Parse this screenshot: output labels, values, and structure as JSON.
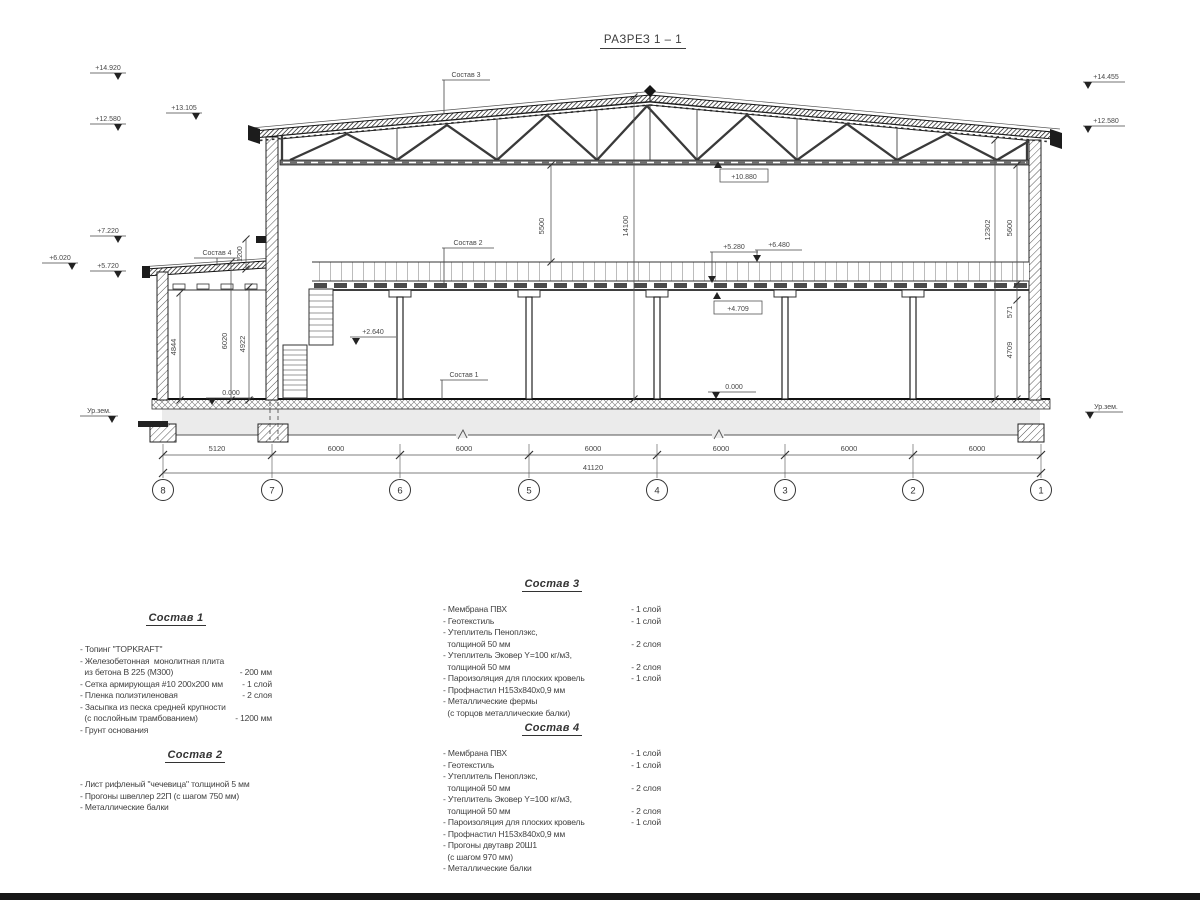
{
  "title": "РАЗРЕЗ 1 – 1",
  "marks": {
    "m14920": "+14.920",
    "m13105": "+13.105",
    "m12580L": "+12.580",
    "m7220": "+7.220",
    "m6020": "+6.020",
    "m5720": "+5.720",
    "m14455": "+14.455",
    "m12580R": "+12.580",
    "m10880": "+10.880",
    "m5280": "+5.280",
    "m6480": "+6.480",
    "m4709": "+4.709",
    "m2640": "+2.640",
    "zeroAnnex": "0.000",
    "zeroHall": "0.000",
    "urzemL": "Ур.зем.",
    "urzemR": "Ур.зем."
  },
  "dims": {
    "v5500": "5500",
    "v14100": "14100",
    "v12302": "12302",
    "v5600": "5600",
    "v571": "571",
    "v4709": "4709",
    "v4844": "4844",
    "v6020": "6020",
    "v4922": "4922",
    "v1200": "1200",
    "bays": [
      "5120",
      "6000",
      "6000",
      "6000",
      "6000",
      "6000",
      "6000"
    ],
    "total": "41120"
  },
  "grid": {
    "bubbles": [
      "8",
      "7",
      "6",
      "5",
      "4",
      "3",
      "2",
      "1"
    ]
  },
  "callouts": {
    "c1": "Состав 1",
    "c2": "Состав 2",
    "c3": "Состав 3",
    "c4": "Состав 4"
  },
  "specs": {
    "s1": {
      "title": "Состав 1",
      "lines": [
        {
          "t": "- Топинг \"TOPKRAFT\"",
          "v": ""
        },
        {
          "t": "- Железобетонная  монолитная плита",
          "v": ""
        },
        {
          "t": "  из бетона В 225 (М300)",
          "v": "- 200 мм"
        },
        {
          "t": "- Сетка армирующая #10 200х200 мм",
          "v": "- 1 слой"
        },
        {
          "t": "- Пленка полиэтиленовая",
          "v": "- 2 слоя"
        },
        {
          "t": "- Засыпка из песка средней крупности",
          "v": ""
        },
        {
          "t": "  (с послойным трамбованием)",
          "v": "- 1200 мм"
        },
        {
          "t": "- Грунт основания",
          "v": ""
        }
      ]
    },
    "s2": {
      "title": "Состав 2",
      "lines": [
        {
          "t": "- Лист рифленый \"чечевица\" толщиной 5 мм",
          "v": ""
        },
        {
          "t": "- Прогоны швеллер 22П (с шагом 750 мм)",
          "v": ""
        },
        {
          "t": "- Металлические балки",
          "v": ""
        }
      ]
    },
    "s3": {
      "title": "Состав 3",
      "lines": [
        {
          "t": "- Мембрана ПВХ",
          "v": "- 1 слой"
        },
        {
          "t": "- Геотекстиль",
          "v": "- 1 слой"
        },
        {
          "t": "- Утеплитель Пеноплэкс,",
          "v": ""
        },
        {
          "t": "  толщиной 50 мм",
          "v": "- 2 слоя"
        },
        {
          "t": "- Утеплитель Эковер Y=100 кг/м3,",
          "v": ""
        },
        {
          "t": "  толщиной 50 мм",
          "v": "- 2 слоя"
        },
        {
          "t": "- Пароизоляция для плоских кровель",
          "v": "- 1 слой"
        },
        {
          "t": "- Профнастил Н153х840х0,9 мм",
          "v": ""
        },
        {
          "t": "- Металлические фермы",
          "v": ""
        },
        {
          "t": "  (с торцов металлические балки)",
          "v": ""
        }
      ]
    },
    "s4": {
      "title": "Состав 4",
      "lines": [
        {
          "t": "- Мембрана ПВХ",
          "v": "- 1 слой"
        },
        {
          "t": "- Геотекстиль",
          "v": "- 1 слой"
        },
        {
          "t": "- Утеплитель Пеноплэкс,",
          "v": ""
        },
        {
          "t": "  толщиной 50 мм",
          "v": "- 2 слоя"
        },
        {
          "t": "- Утеплитель Эковер Y=100 кг/м3,",
          "v": ""
        },
        {
          "t": "  толщиной 50 мм",
          "v": "- 2 слоя"
        },
        {
          "t": "- Пароизоляция для плоских кровель",
          "v": "- 1 слой"
        },
        {
          "t": "- Профнастил Н153х840х0,9 мм",
          "v": ""
        },
        {
          "t": "- Прогоны двутавр 20Ш1",
          "v": ""
        },
        {
          "t": "  (с шагом 970 мм)",
          "v": ""
        },
        {
          "t": "- Металлические балки",
          "v": ""
        }
      ]
    }
  }
}
